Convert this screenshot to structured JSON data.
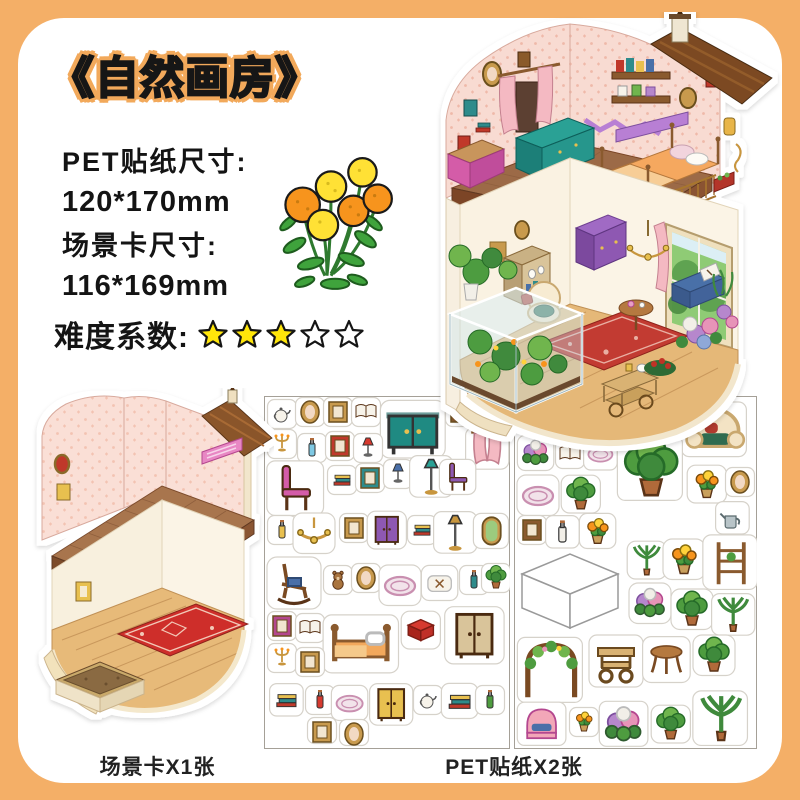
{
  "title": "《自然画房》",
  "specs": {
    "pet_label": "PET贴纸尺寸:",
    "pet_value": "120*170mm",
    "card_label": "场景卡尺寸:",
    "card_value": "116*169mm"
  },
  "difficulty": {
    "label": "难度系数:",
    "filled": 3,
    "total": 5
  },
  "captions": {
    "scene_card": "场景卡X1张",
    "stickers": "PET贴纸X2张"
  },
  "colors": {
    "background": "#F4AF67",
    "title_halo": "#F2A95B",
    "star_yellow": "#FFE60A",
    "text": "#141414",
    "wallpaper_pink": "#F8DBD2",
    "floor_brown": "#A8754E",
    "wood_floor": "#E5B878",
    "rug_red": "#C23A30"
  }
}
